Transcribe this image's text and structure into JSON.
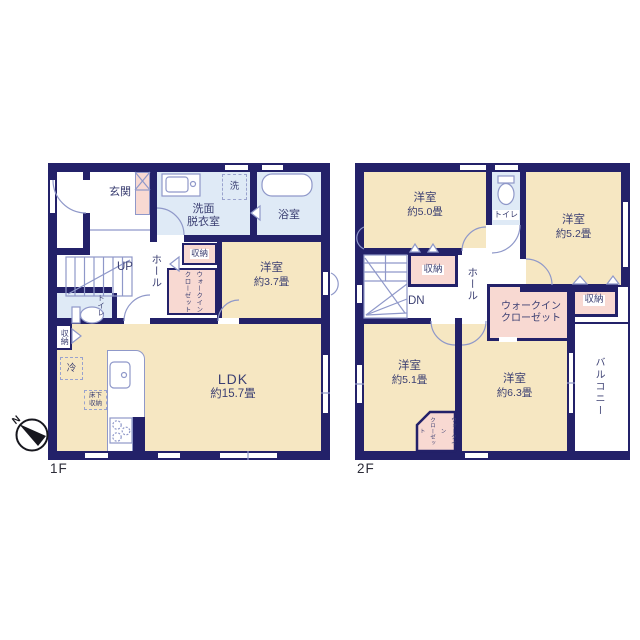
{
  "palette": {
    "wall": "#232169",
    "room_beige": "#F6E7C2",
    "closet_pink": "#F8D9D2",
    "wet_area_blue": "#DFEAF6",
    "thin_line": "#8F98C9",
    "label_text": "#3B3F72"
  },
  "compass": {
    "north": "N"
  },
  "floor1": {
    "label": "1F",
    "rooms": {
      "entrance": {
        "name": "玄関"
      },
      "washroom": {
        "name": "洗面\n脱衣室"
      },
      "washer": {
        "name": "洗"
      },
      "bathroom": {
        "name": "浴室"
      },
      "hall": {
        "name": "ホール"
      },
      "stairs": {
        "name": "UP"
      },
      "storage_hall": {
        "name": "収納"
      },
      "walk_in_closet": {
        "name": "ウォークイン\nクローゼット"
      },
      "western_room": {
        "name": "洋室",
        "size": "約3.7畳"
      },
      "toilet": {
        "name": "トイレ"
      },
      "storage_ldk": {
        "name": "収納"
      },
      "ldk": {
        "name": "LDK",
        "size": "約15.7畳"
      },
      "fridge": {
        "name": "冷"
      },
      "underfloor_storage": {
        "name": "床下\n収納"
      }
    }
  },
  "floor2": {
    "label": "2F",
    "rooms": {
      "western_room_50": {
        "name": "洋室",
        "size": "約5.0畳"
      },
      "toilet": {
        "name": "トイレ"
      },
      "western_room_52": {
        "name": "洋室",
        "size": "約5.2畳"
      },
      "storage_left": {
        "name": "収納"
      },
      "hall": {
        "name": "ホール"
      },
      "stairs": {
        "name": "DN"
      },
      "walk_in_closet_main": {
        "name": "ウォークイン\nクローゼット"
      },
      "storage_right": {
        "name": "収納"
      },
      "western_room_51": {
        "name": "洋室",
        "size": "約5.1畳"
      },
      "western_room_63": {
        "name": "洋室",
        "size": "約6.3畳"
      },
      "walk_in_closet_small": {
        "name": "ウォークイン\nクローゼット"
      },
      "balcony": {
        "name": "バルコニー"
      }
    }
  }
}
